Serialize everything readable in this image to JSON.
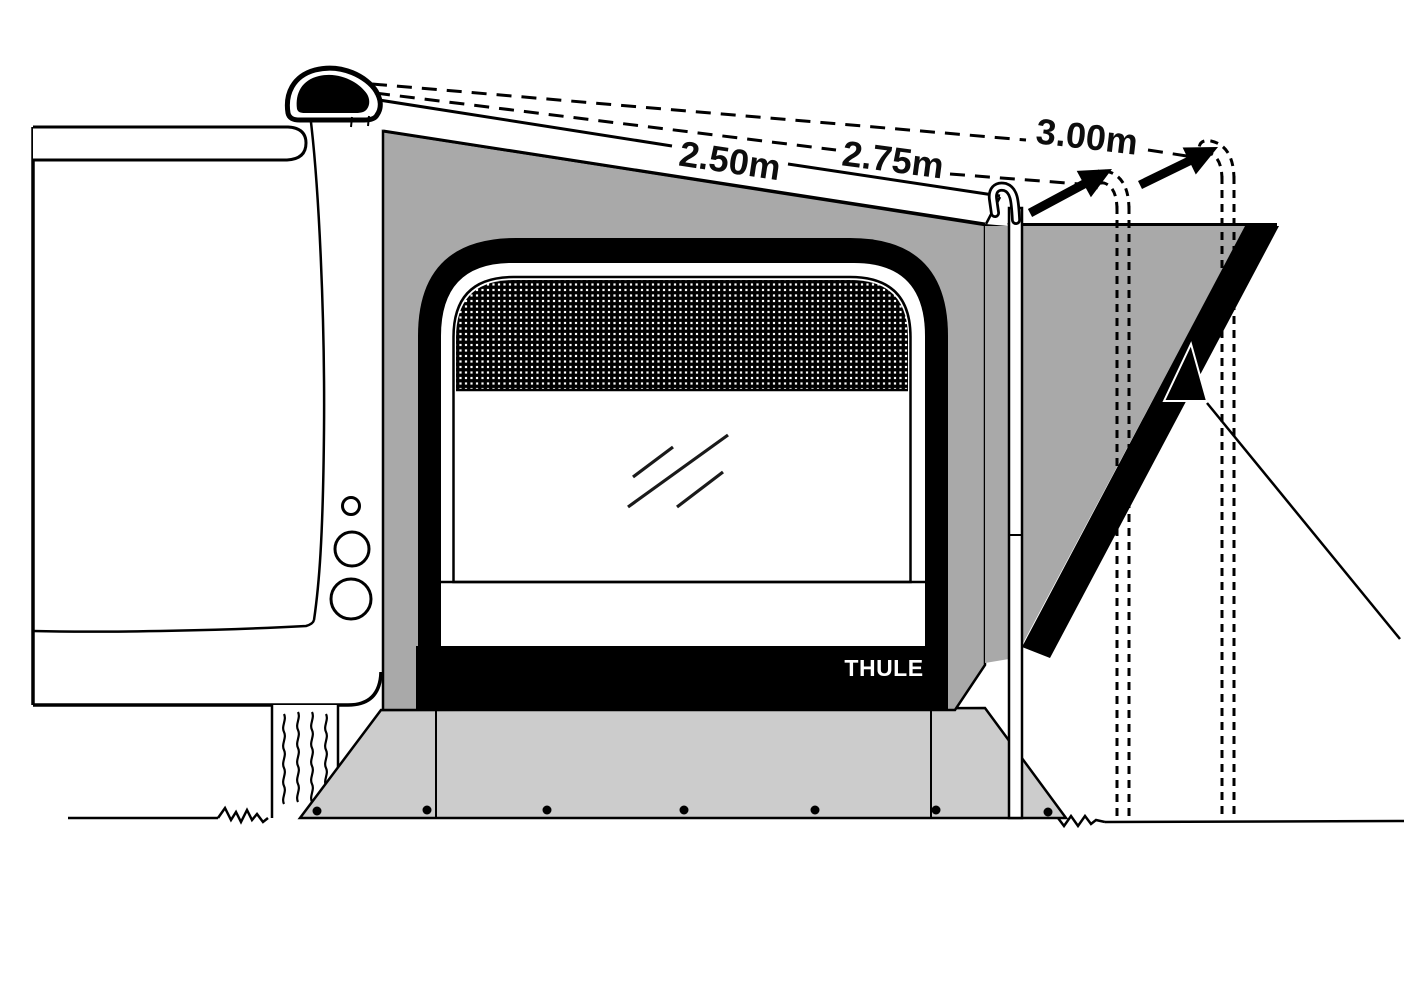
{
  "diagram": {
    "title": "Awning depth options side-view diagram",
    "brand_label": "THULE",
    "dimension_labels": {
      "awning_250": "2.50m",
      "awning_275": "2.75m",
      "awning_300": "3.00m"
    },
    "colors": {
      "outline": "#000000",
      "awning_wall_gray": "#a9a9a9",
      "skirt_gray": "#cccccc",
      "background": "#ffffff"
    }
  }
}
